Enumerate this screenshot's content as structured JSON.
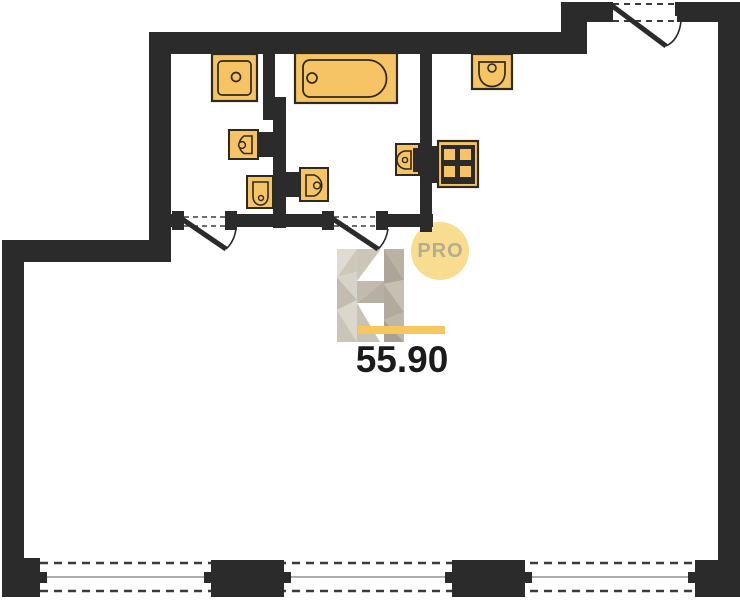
{
  "floorplan": {
    "type": "apartment-floor-plan",
    "area_label": "55.90",
    "badge_label": "PRO",
    "colors": {
      "walls": "#2B2B2B",
      "fixture_fill": "#F6C464",
      "fixture_outline": "#2E2A1E",
      "badge_fill": "#F8DC8F",
      "badge_text": "#B5AD90",
      "accent_bar": "#F6C75E",
      "watermark_light": "#DFDACF",
      "watermark_dark": "#ACA597",
      "window_glass_line": "#909090",
      "background": "#FFFFFF"
    },
    "fixtures": [
      {
        "name": "washbasin",
        "room": "bathroom-left"
      },
      {
        "name": "toilet",
        "room": "bathroom-left"
      },
      {
        "name": "bidet",
        "room": "bathroom-left"
      },
      {
        "name": "bathtub",
        "room": "bathroom-right"
      },
      {
        "name": "toilet",
        "room": "bathroom-right"
      },
      {
        "name": "wall-washbasin",
        "room": "bathroom-right"
      },
      {
        "name": "kitchen-sink",
        "room": "kitchen"
      },
      {
        "name": "stove-4-burners",
        "room": "kitchen"
      }
    ],
    "openings": {
      "bottom_windows": 3,
      "interior_door_swings": 2,
      "balcony_door_swings": 1
    }
  }
}
